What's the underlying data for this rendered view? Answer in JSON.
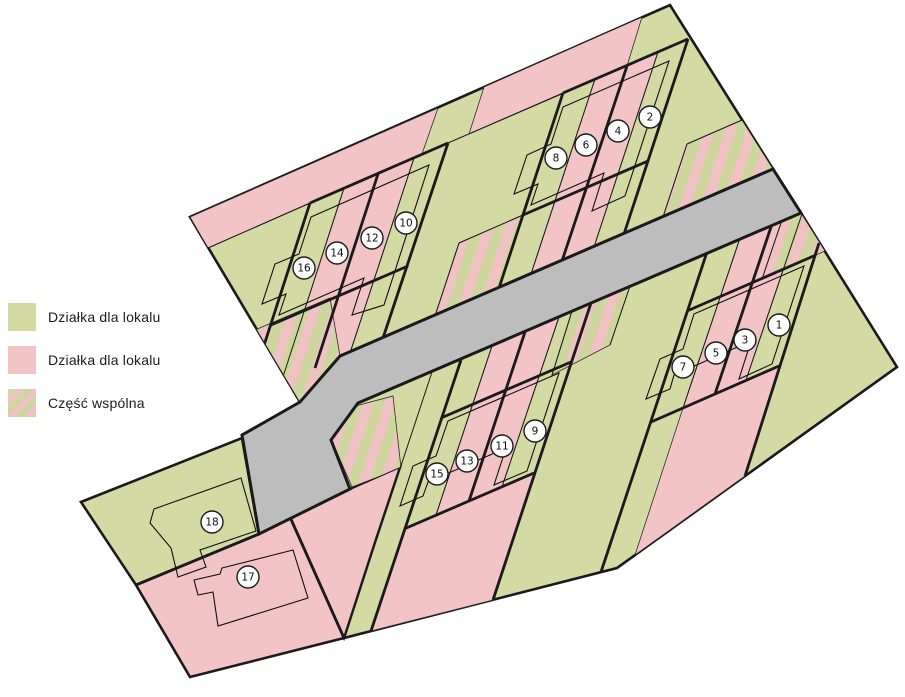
{
  "title": "Site plan of parcels",
  "legend": {
    "items": [
      {
        "label": "Działka dla lokalu",
        "type": "green"
      },
      {
        "label": "Działka dla lokalu",
        "type": "pink"
      },
      {
        "label": "Część wspólna",
        "type": "striped"
      }
    ]
  },
  "colors": {
    "green": "#d3daa3",
    "pink": "#f2c4c6",
    "road": "#bdbdbd",
    "outline": "#1a1a1a",
    "stripe_green": "#cdd69c",
    "stripe_pink": "#f0c2c4",
    "circle_fill": "#ffffff"
  },
  "plots": [
    {
      "number": "1"
    },
    {
      "number": "2"
    },
    {
      "number": "3"
    },
    {
      "number": "4"
    },
    {
      "number": "5"
    },
    {
      "number": "6"
    },
    {
      "number": "7"
    },
    {
      "number": "8"
    },
    {
      "number": "9"
    },
    {
      "number": "10"
    },
    {
      "number": "11"
    },
    {
      "number": "12"
    },
    {
      "number": "13"
    },
    {
      "number": "14"
    },
    {
      "number": "15"
    },
    {
      "number": "16"
    },
    {
      "number": "17"
    },
    {
      "number": "18"
    }
  ]
}
